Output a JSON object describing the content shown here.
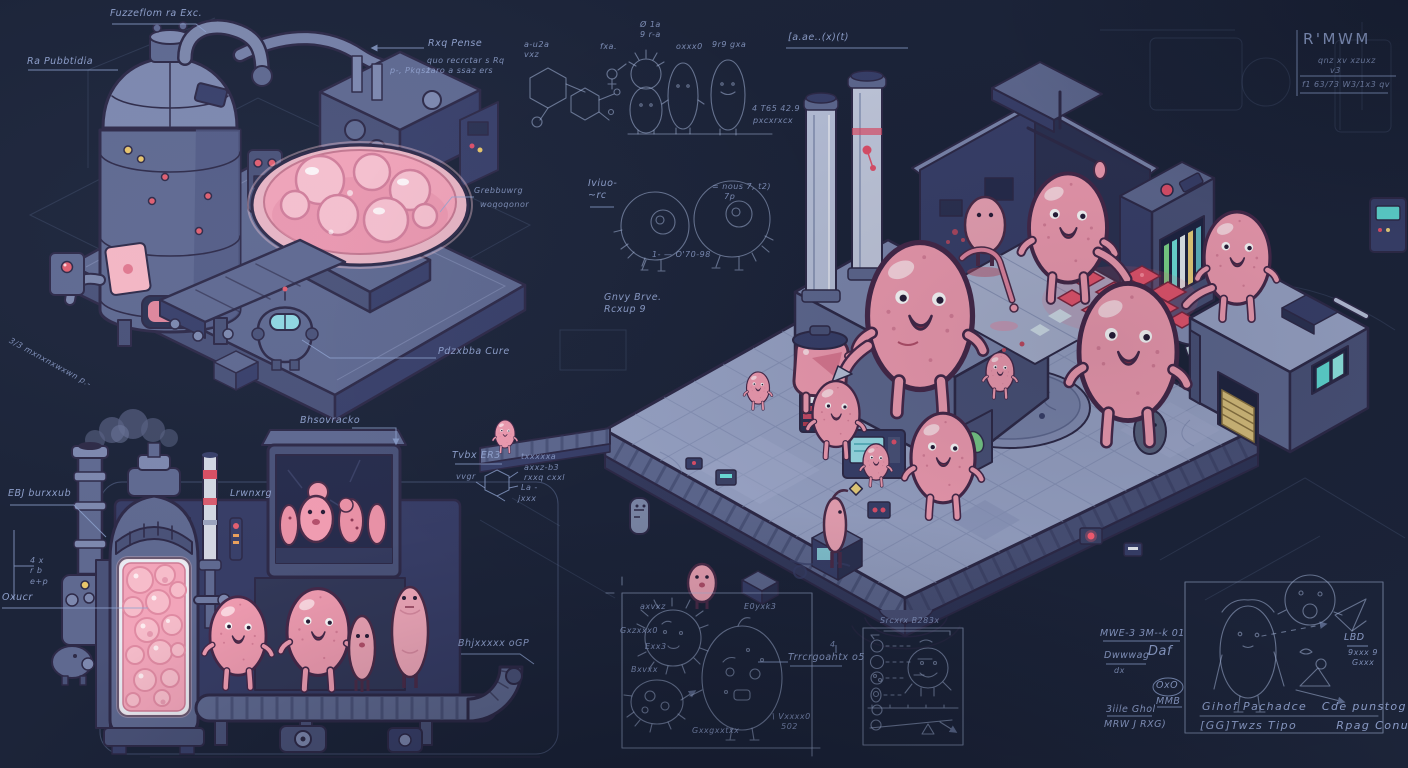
{
  "artwork": {
    "style": "isometric blueprint concept art",
    "subject": "pink blob creature factory with annotated machines and sketches",
    "background_color": "#1c2439",
    "line_color": "#97a9d6",
    "blob_pink": "#f09cb1",
    "glow_red": "#ff5f74",
    "screen_teal": "#6fe3dc",
    "stripe_red": "#d94f63"
  },
  "notes": [
    {
      "area": "top-left-machine",
      "text": "Fuzzeflom ra Exc."
    },
    {
      "area": "top-left-machine",
      "text": "Ra Pubbtidia"
    },
    {
      "area": "top-left-machine",
      "text": "Rxq Pense"
    },
    {
      "area": "top-left-machine",
      "text": "quo recrctar s Rq"
    },
    {
      "area": "top-left-machine",
      "text": "taro a ssaz ers"
    },
    {
      "area": "top-left-machine",
      "text": "p-, Pkqsz"
    },
    {
      "area": "top-left-machine",
      "text": "Grebbuwrg"
    },
    {
      "area": "top-left-machine",
      "text": "woqoqonor"
    },
    {
      "area": "top-left-machine",
      "text": "Pdzxbba Cure"
    },
    {
      "area": "bottom-left-factory",
      "text": "Bhsovracko"
    },
    {
      "area": "top-left-machine",
      "text": "3/3 mxnxnxwxwn p.-"
    },
    {
      "area": "bottom-left-factory",
      "text": "EBJ burxxub"
    },
    {
      "area": "bottom-left-factory",
      "text": "4 x\nr b\ne+p"
    },
    {
      "area": "bottom-left-factory",
      "text": "Oxucr"
    },
    {
      "area": "bottom-left-factory",
      "text": "Tvbx ER3"
    },
    {
      "area": "hexagon-sketch",
      "text": "txxxxxa"
    },
    {
      "area": "hexagon-sketch",
      "text": "axxz-b3"
    },
    {
      "area": "hexagon-sketch",
      "text": "rxxq cxxl"
    },
    {
      "area": "hexagon-sketch",
      "text": "La -"
    },
    {
      "area": "hexagon-sketch",
      "text": "vvgr"
    },
    {
      "area": "hexagon-sketch",
      "text": "jxxx"
    },
    {
      "area": "bottom-left-factory",
      "text": "Lrwnxrg"
    },
    {
      "area": "bottom-left-factory",
      "text": "Bhjxxxxx oGP"
    },
    {
      "area": "center-sketches",
      "text": "4 T65 42.9"
    },
    {
      "area": "center-sketches",
      "text": "pxcxrxcx"
    },
    {
      "area": "center-sketches",
      "text": "Iviuo-\n~rc"
    },
    {
      "area": "center-sketches",
      "text": "= nous 7, t2)\n    7p"
    },
    {
      "area": "top-center",
      "text": "[a.ae..(x)(t)"
    },
    {
      "area": "center-left-of-floor",
      "text": "Gnvy Brve.\nRcxup 9"
    },
    {
      "area": "cell-sketches",
      "text": "1- — O'70-98"
    },
    {
      "area": "top-right-block",
      "text": "R'MWM"
    },
    {
      "area": "top-right-block",
      "text": "qnz xv xzuxz"
    },
    {
      "area": "top-right-block",
      "text": "v3"
    },
    {
      "area": "top-right-block",
      "text": "f1 63/73 W3/1x3 qv"
    },
    {
      "area": "character-sketches",
      "text": "a-u2a\nvxz"
    },
    {
      "area": "character-sketches",
      "text": "fxa."
    },
    {
      "area": "character-sketches",
      "text": "Ø 1a\n9 r-a"
    },
    {
      "area": "character-sketches",
      "text": "oxxx0"
    },
    {
      "area": "character-sketches",
      "text": "9r9 gxa"
    },
    {
      "area": "germ-panel",
      "text": "axvxz"
    },
    {
      "area": "germ-panel",
      "text": "E0yxk3"
    },
    {
      "area": "germ-panel",
      "text": "Gxzxxx0"
    },
    {
      "area": "germ-panel",
      "text": "Exx3"
    },
    {
      "area": "germ-panel",
      "text": "Bxvxx"
    },
    {
      "area": "germ-panel",
      "text": "Gxxgxxtxx"
    },
    {
      "area": "germ-panel",
      "text": "\\ Vxxxx0\n   502"
    },
    {
      "area": "germ-panel",
      "text": "Trrcrgoahtx o5"
    },
    {
      "area": "germ-panel",
      "text": "4"
    },
    {
      "area": "spec-panel",
      "text": "Srcxrx B283x"
    },
    {
      "area": "bottom-right-notes",
      "text": "MWE-3 3M--k 01"
    },
    {
      "area": "bottom-right-notes",
      "text": "Dwwwag"
    },
    {
      "area": "bottom-right-notes",
      "text": "Daf"
    },
    {
      "area": "bottom-right-notes",
      "text": "dx"
    },
    {
      "area": "bottom-right-notes",
      "text": "OxO"
    },
    {
      "area": "bottom-right-notes",
      "text": "MMB"
    },
    {
      "area": "bottom-right-notes",
      "text": "3iile Ghol"
    },
    {
      "area": "bottom-right-notes",
      "text": "MRW J RXG)"
    },
    {
      "area": "bottom-right-panel",
      "text": "Gihof Pachadce   Cde punstog Of"
    },
    {
      "area": "bottom-right-panel",
      "text": "[GG]Twzs Tipo        Rpag Conust"
    },
    {
      "area": "bottom-right-panel",
      "text": "LBD"
    },
    {
      "area": "bottom-right-panel",
      "text": "9xxx 9"
    },
    {
      "area": "bottom-right-panel",
      "text": "Gxxx"
    }
  ]
}
